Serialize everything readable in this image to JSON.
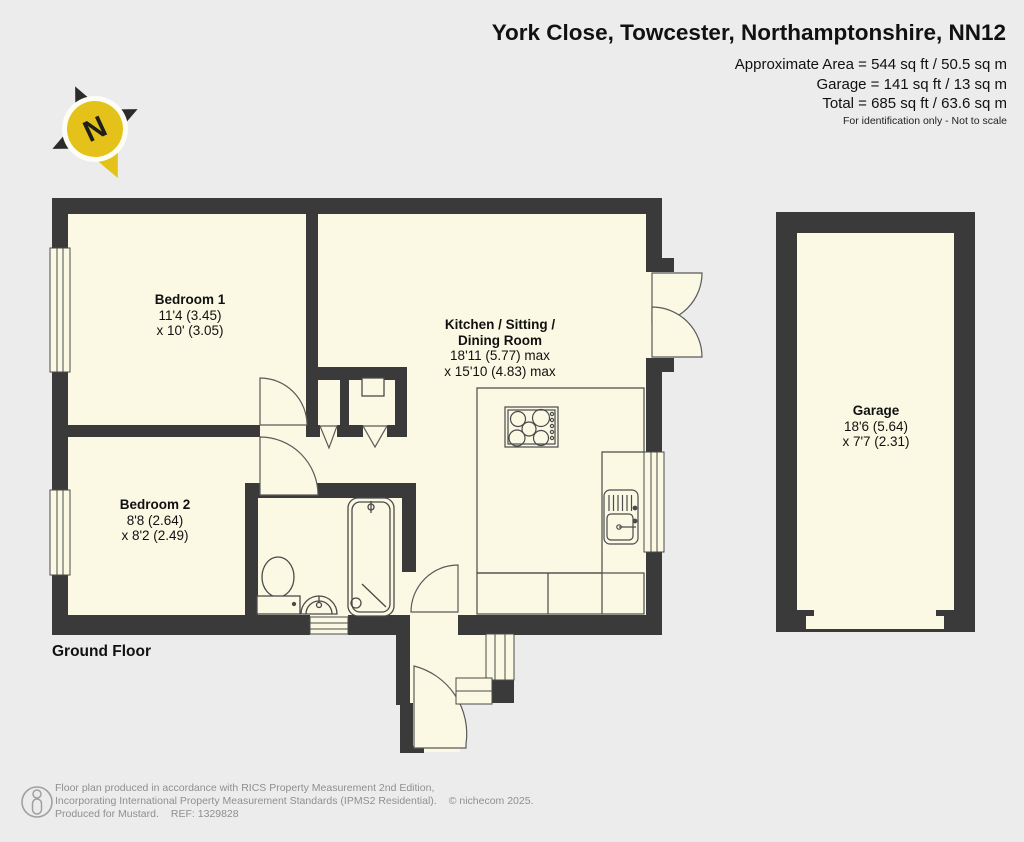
{
  "header": {
    "title": "York Close, Towcester, Northamptonshire, NN12",
    "area_line1": "Approximate Area = 544 sq ft / 50.5 sq m",
    "area_line2": "Garage = 141 sq ft / 13 sq m",
    "area_line3": "Total = 685 sq ft / 63.6 sq m",
    "disclaimer": "For identification only - Not to scale"
  },
  "compass": {
    "label": "N"
  },
  "floor": {
    "label": "Ground Floor"
  },
  "rooms": {
    "bedroom1": {
      "name": "Bedroom 1",
      "dim1": "11'4 (3.45)",
      "dim2": "x 10' (3.05)"
    },
    "kitchen": {
      "name_line1": "Kitchen / Sitting /",
      "name_line2": "Dining Room",
      "dim1": "18'11 (5.77) max",
      "dim2": "x 15'10 (4.83) max"
    },
    "bedroom2": {
      "name": "Bedroom 2",
      "dim1": "8'8 (2.64)",
      "dim2": "x 8'2 (2.49)"
    },
    "garage": {
      "name": "Garage",
      "dim1": "18'6 (5.64)",
      "dim2": "x 7'7 (2.31)"
    }
  },
  "footer": {
    "line1": "Floor plan produced in accordance with RICS Property Measurement 2nd Edition,",
    "line2": "Incorporating International Property Measurement Standards (IPMS2 Residential).",
    "copyright": "© nichecom 2025.",
    "produced": "Produced for Mustard.",
    "ref": "REF: 1329828"
  },
  "colors": {
    "wall": "#3a3a3a",
    "room_fill": "#fbf9e4",
    "background": "#ececec",
    "compass_yellow": "#e4c219",
    "fixture_line": "#4a4a4a",
    "footer_text": "#8f8f8f"
  }
}
